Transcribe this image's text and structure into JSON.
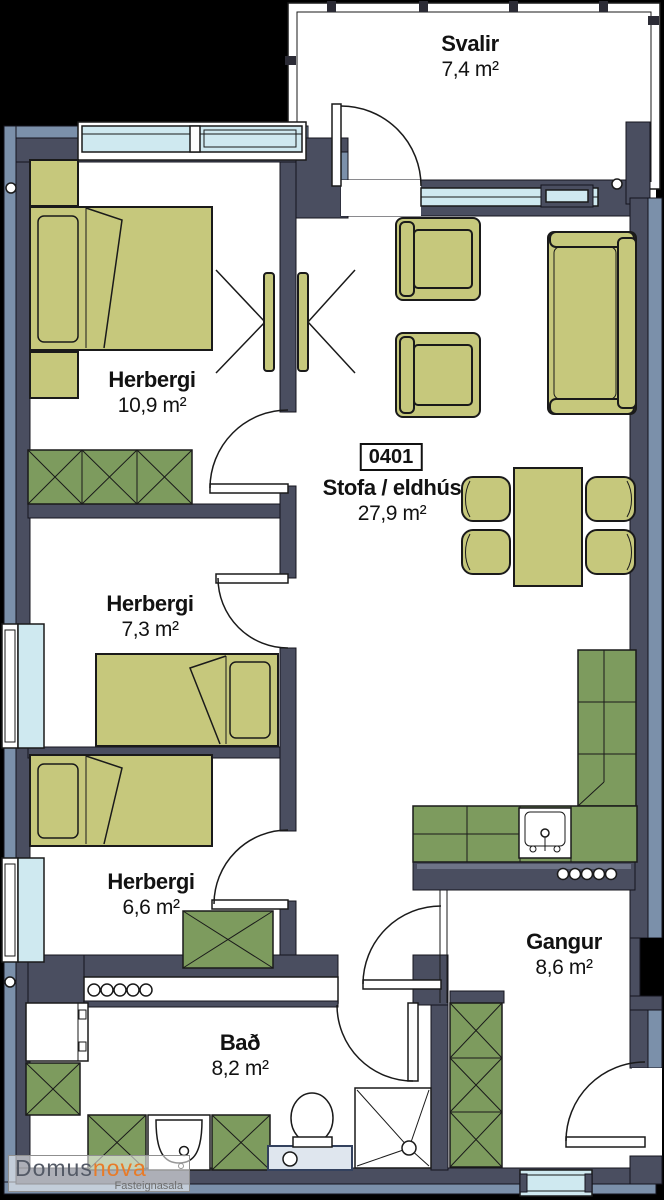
{
  "title": "Floor plan unit 0401",
  "unit_label": "0401",
  "rooms": {
    "svalir": {
      "name": "Svalir",
      "area": "7,4 m²"
    },
    "herbergi1": {
      "name": "Herbergi",
      "area": "10,9 m²"
    },
    "stofa": {
      "name": "Stofa / eldhús",
      "area": "27,9 m²"
    },
    "herbergi2": {
      "name": "Herbergi",
      "area": "7,3 m²"
    },
    "herbergi3": {
      "name": "Herbergi",
      "area": "6,6 m²"
    },
    "gangur": {
      "name": "Gangur",
      "area": "8,6 m²"
    },
    "bad": {
      "name": "Bað",
      "area": "8,2 m²"
    }
  },
  "logo": {
    "brand_primary": "Domus",
    "brand_secondary": "nova",
    "tagline": "Fasteignasala"
  },
  "colors": {
    "bg": "#000000",
    "wall-dark": "#4a4e60",
    "wall-blue": "#7b90aa",
    "window": "#cfe9f0",
    "furniture": "#c6c87c",
    "cabinet": "#7d9b5e",
    "logo-accent": "#e87b28",
    "logo-gray": "#545a66"
  }
}
